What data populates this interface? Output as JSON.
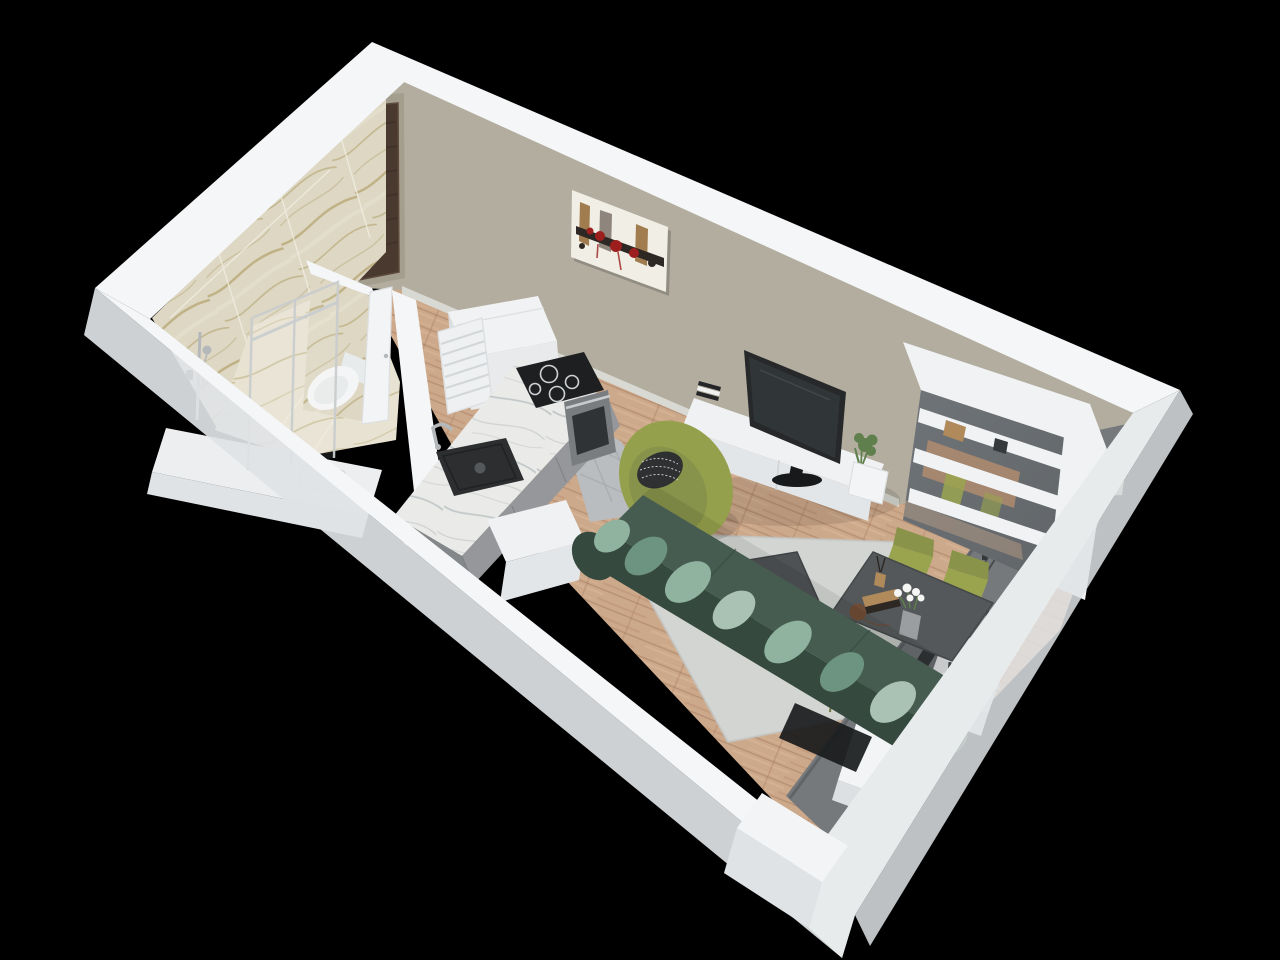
{
  "scene": {
    "type": "3d-isometric-floorplan-render",
    "rooms": [
      {
        "name": "bathroom"
      },
      {
        "name": "entry-hall"
      },
      {
        "name": "kitchen"
      },
      {
        "name": "living-area"
      },
      {
        "name": "dining-area"
      },
      {
        "name": "balcony"
      }
    ],
    "objects": [
      "entry-door",
      "bathroom-door",
      "wall-art",
      "shower-enclosure",
      "shower-fixture",
      "toilet",
      "vanity-counter",
      "towel-radiator",
      "tall-cabinet",
      "kitchen-counter",
      "kitchen-sink",
      "faucet",
      "cooktop",
      "oven",
      "gray-floor-tiles",
      "wood-floor",
      "area-rug",
      "sofa",
      "sofa-cushions",
      "armchair",
      "accent-pillow",
      "coffee-table",
      "decor-flowers",
      "tv",
      "tv-console",
      "books",
      "potted-plant",
      "shelving-unit",
      "dining-table",
      "dining-chair",
      "flower-vase",
      "floor-plant",
      "balcony-doors",
      "balcony-floor",
      "wall-column"
    ],
    "counts": {
      "dining_chairs": 4,
      "cooktop_burners": 4,
      "sofa_pillows": 7
    }
  },
  "colors": {
    "background": "#000000",
    "wall_top": "#f4f6f7",
    "wall_top_shade": "#e8ebec",
    "wall_outer": "#dfe3e5",
    "back_wall": "#b2ad9f",
    "back_wall_shade": "#a49e8f",
    "skirting": "#d9d9d3",
    "door_wood": "#4a392f",
    "door_wood_dark": "#382b23",
    "door_frame": "#5d4a3d",
    "chrome": "#c9ccce",
    "fixture_chrome": "#b4b8ba",
    "canvas": "#f1eee6",
    "art_dark": "#2d2824",
    "art_red": "#9c1f1d",
    "art_tan": "#a07c4f",
    "art_gray": "#8e867c",
    "marble_base": "#ddd7c4",
    "marble_vein": "#b3a16a",
    "marble_floor": "#e7e2d1",
    "grout": "#f2efe3",
    "toilet_white": "#f4f5f6",
    "toilet_shade": "#e8ebeb",
    "vanity_white": "#eceeef",
    "radiator_white": "#eef0f1",
    "radiator_line": "#d3d7d9",
    "tall_cabinet_white": "#f0f2f3",
    "tall_cabinet_front": "#e8eaec",
    "tall_cabinet_side": "#dcdfe1",
    "counter_marble": "#eaebe9",
    "counter_vein": "#b9bfc0",
    "cabinet_gray": "#95979a",
    "cabinet_gray_dark": "#84878a",
    "cooktop_black": "#1d1f21",
    "ring_white": "#cfd2d4",
    "oven_steel": "#797d80",
    "oven_dark": "#303335",
    "sink_black": "#2c2e30",
    "drain_gray": "#55585a",
    "tile_gray": "#babdbf",
    "tile_joint": "#a6a9ab",
    "wood_base": "#cda98b",
    "wood_dark": "#b98f6f",
    "wood_light": "#deba9b",
    "wood_seam": "#a87e60",
    "rug": "#d3d5d2",
    "rug_shade": "#c3c6c3",
    "sofa_dark": "#35493f",
    "sofa_mid": "#465c50",
    "sofa_deep": "#2f4a3e",
    "pillow_light": "#8fb39e",
    "pillow_mid": "#6d9480",
    "pillow_pale": "#a9c2b3",
    "armchair_olive": "#95a04d",
    "armchair_olive_dark": "#87924a",
    "pillow_bw_dark": "#2e3032",
    "pillow_bw_light": "#d8dadb",
    "black_metal": "#232527",
    "coffee_table": "#4e5254",
    "coffee_table_edge": "#3f4345",
    "flowers_tan": "#c3a478",
    "candle_white": "#f0f1f1",
    "console_white": "#eff1f2",
    "console_front": "#e3e6e8",
    "console_seam": "#cfd3d5",
    "tv_dark": "#26282a",
    "tv_screen": "#323639",
    "tv_base": "#17191a",
    "plant_green": "#5f7f4c",
    "vase_gray": "#9a9ea0",
    "shelf_white": "#f0f2f3",
    "shelf_back": "#6f7478",
    "dining_table": "#54585a",
    "dining_table_edge": "#44484a",
    "chair_olive": "#9aa44f",
    "chair_olive_dark": "#89934a",
    "chair_leg": "#6d7440",
    "book_tan": "#b08a5a",
    "ball_brown": "#6f4c36",
    "flower_white": "#f5f6f4",
    "balcony_gray": "#75797c",
    "balcony_dark": "#5e6265",
    "frame_dark": "#36393c",
    "track_black": "#191b1c",
    "pillar_white": "#f2f4f5",
    "pillar_shade": "#dde0e2",
    "shadow": "#000000"
  }
}
